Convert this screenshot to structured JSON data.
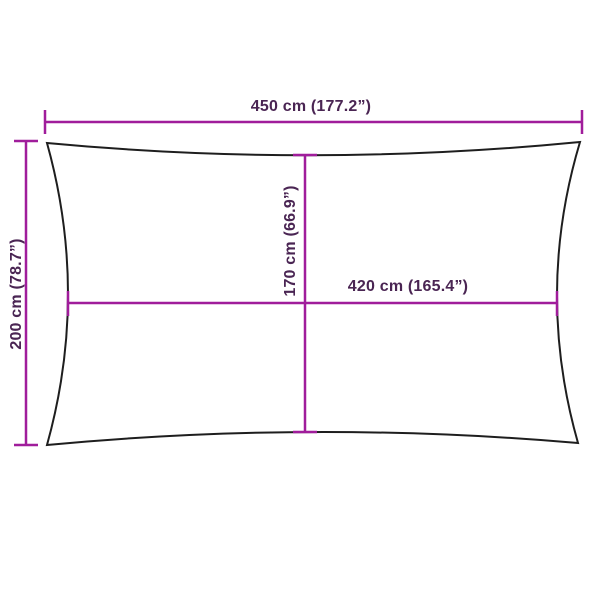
{
  "colors": {
    "background": "#FFFFFF",
    "dimension_line": "#A01D9B",
    "sail_outline": "#1E1E1E",
    "label_text": "#4A2553"
  },
  "dimensions": {
    "width": {
      "label": "450 cm (177.2”)",
      "value_cm": 450,
      "value_in": 177.2
    },
    "height": {
      "label": "200 cm (78.7”)",
      "value_cm": 200,
      "value_in": 78.7
    },
    "inner_height": {
      "label": "170 cm (66.9”)",
      "value_cm": 170,
      "value_in": 66.9
    },
    "inner_width": {
      "label": "420 cm (165.4”)",
      "value_cm": 420,
      "value_in": 165.4
    }
  }
}
